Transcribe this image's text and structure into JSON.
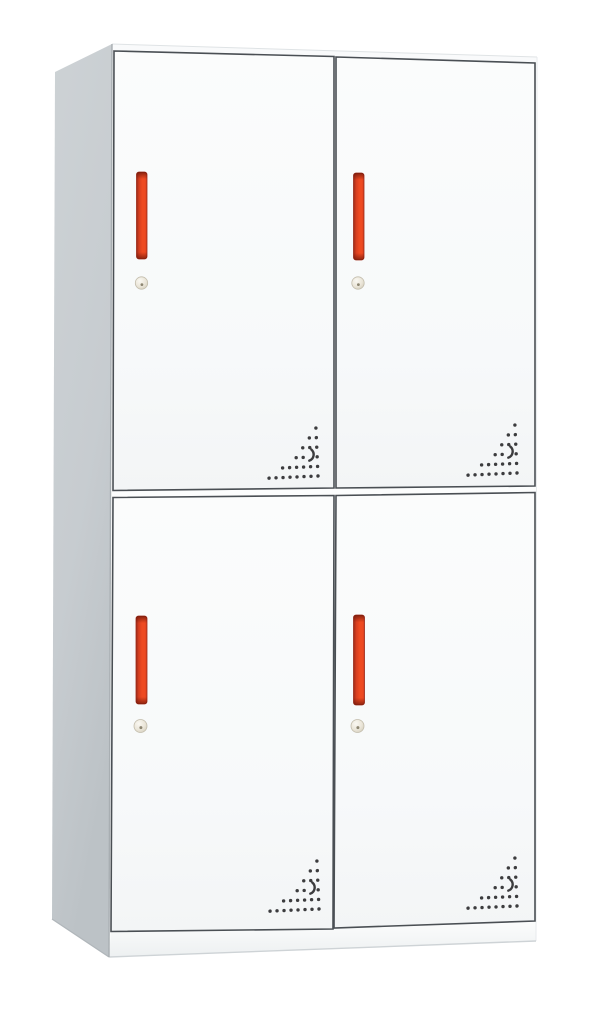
{
  "meta": {
    "type": "product-image",
    "subject": "White 4-door steel locker cabinet with red vertical handles, cylinder keyholes and triangular ventilation hole patterns, shown in three-quarter perspective on a white background",
    "rows": 2,
    "columns": 2,
    "door_count": 4
  },
  "cabinet": {
    "doors": [
      {
        "id": "top-left",
        "handle": "vertical-red-bar-handle",
        "lock": "cylinder-keyhole",
        "vents": "triangular-dot-vent-pattern"
      },
      {
        "id": "top-right",
        "handle": "vertical-red-bar-handle",
        "lock": "cylinder-keyhole",
        "vents": "triangular-dot-vent-pattern"
      },
      {
        "id": "bottom-left",
        "handle": "vertical-red-bar-handle",
        "lock": "cylinder-keyhole",
        "vents": "triangular-dot-vent-pattern"
      },
      {
        "id": "bottom-right",
        "handle": "vertical-red-bar-handle",
        "lock": "cylinder-keyhole",
        "vents": "triangular-dot-vent-pattern"
      }
    ],
    "colors": {
      "background": "#ffffff",
      "body_white": "#fcfdfd",
      "side_panel": "#c7ccd0",
      "side_panel_dark": "#bcc2c6",
      "gap_line": "#4a4f54",
      "handle_bright": "#ee4a21",
      "handle_main": "#d63e1f",
      "handle_dark": "#9c2a18",
      "handle_end": "#6f1709",
      "keyhole_metal": "#ded9ca",
      "keyhole_ring": "#c2bcab",
      "vent_dot": "#3c3c3e",
      "edge_light": "#dfe3e5"
    }
  },
  "vent_pattern": {
    "shape": "right-triangle-dot-grid",
    "dx": 7,
    "dy": 9.6,
    "dot_radius": 1.7,
    "tilt_deg": -2.5,
    "rows": [
      {
        "offset": 0,
        "count": 8
      },
      {
        "offset": 1,
        "count": 6
      },
      {
        "offset": 2,
        "count": 4,
        "crescent_col": 1
      },
      {
        "offset": 3,
        "count": 3
      },
      {
        "offset": 4,
        "count": 2
      },
      {
        "offset": 5,
        "count": 1
      }
    ]
  }
}
